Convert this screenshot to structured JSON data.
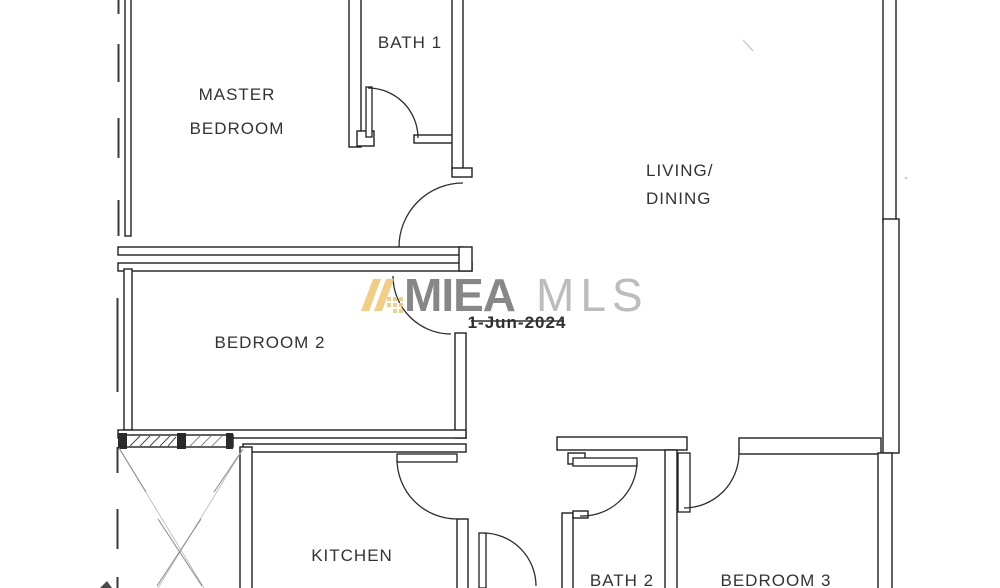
{
  "document": {
    "type": "residential floor plan (scanned)"
  },
  "rooms": {
    "master_bedroom": {
      "line1": "MASTER",
      "line2": "BEDROOM"
    },
    "bath1": {
      "label": "BATH 1"
    },
    "living_dining": {
      "line1": "LIVING/",
      "line2": "DINING"
    },
    "bedroom2": {
      "label": "BEDROOM 2"
    },
    "kitchen": {
      "label": "KITCHEN"
    },
    "bath2": {
      "label": "BATH 2"
    },
    "bedroom3": {
      "label": "BEDROOM 3"
    }
  },
  "watermark": {
    "brand_primary": "MIEA",
    "brand_secondary": "MLS",
    "date": "1-Jun-2024"
  },
  "colors": {
    "background": "#ffffff",
    "wall_line": "#1f1f1f",
    "room_label": "#333333",
    "watermark_primary": "#878787",
    "watermark_secondary": "#bcbcbc",
    "watermark_logo": "#f0ca7a",
    "watermark_date": "#303030",
    "yard_hatch": "#8e8e8e"
  }
}
